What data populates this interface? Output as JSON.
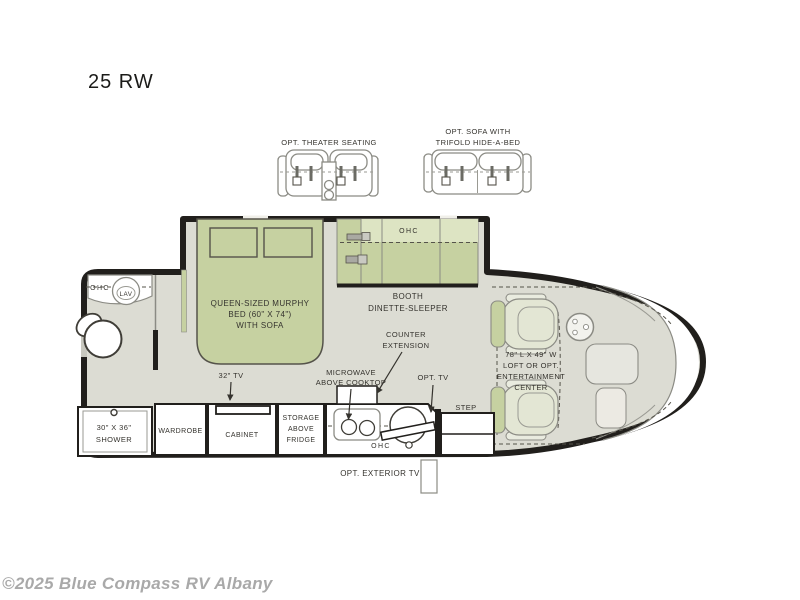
{
  "title": "25 RW",
  "watermark": "©2025 Blue Compass RV Albany",
  "colors": {
    "floor": "#dcdcd3",
    "furniture_green": "#c6d1a1",
    "furniture_green_light": "#dde4c3",
    "wall": "#211f1c",
    "outline_gray": "#8b8b84",
    "label_text": "#35332e",
    "watermark_gray": "#a9a9a9"
  },
  "options": {
    "theater_seating_label": "OPT. THEATER SEATING",
    "sofa_label_line1": "OPT. SOFA WITH",
    "sofa_label_line2": "TRIFOLD HIDE-A-BED"
  },
  "labels": {
    "bath_ohc": "OHC",
    "lav": "LAV",
    "shower_line1": "30\" X 36\"",
    "shower_line2": "SHOWER",
    "bed_line1": "QUEEN-SIZED MURPHY",
    "bed_line2": "BED (60\" X 74\")",
    "bed_line3": "WITH SOFA",
    "dinette_ohc": "OHC",
    "booth_line1": "BOOTH",
    "booth_line2": "DINETTE-SLEEPER",
    "tv32": "32\" TV",
    "wardrobe": "WARDROBE",
    "cabinet": "CABINET",
    "storage_line1": "STORAGE",
    "storage_line2": "ABOVE",
    "storage_line3": "FRIDGE",
    "counter_ext_line1": "COUNTER",
    "counter_ext_line2": "EXTENSION",
    "microwave_line1": "MICROWAVE",
    "microwave_line2": "ABOVE COOKTOP",
    "opt_tv": "OPT. TV",
    "kitchen_ohc": "OHC",
    "step": "STEP",
    "loft_line1": "78\" L X 49\" W",
    "loft_line2": "LOFT OR OPT.",
    "loft_line3": "ENTERTAINMENT",
    "loft_line4": "CENTER",
    "opt_exterior_tv": "OPT. EXTERIOR TV"
  }
}
